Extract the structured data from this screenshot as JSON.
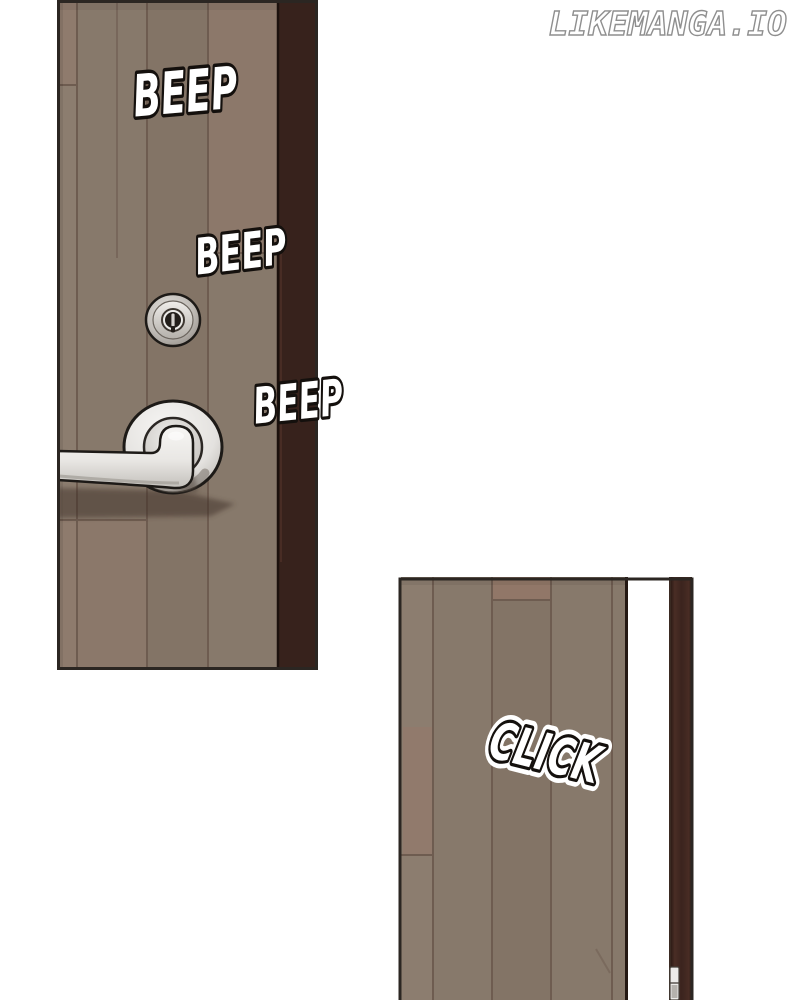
{
  "watermark": {
    "text": "LIKEMANGA.IO"
  },
  "sfx": {
    "beep_top": "BEEP",
    "beep_middle": "BEEP",
    "beep_bottom": "BEEP",
    "click": "CLICK"
  },
  "colors": {
    "background": "#ffffff",
    "panel-border": "#2b2622",
    "door-face": "#87796b",
    "door-face-light": "#8c7d6f",
    "door-face-dark": "#837466",
    "door-red-tint": "#96786a",
    "door-plank-line": "#6e5c50",
    "door-edge-strip": "#37221c",
    "door-edge-line": "#241813",
    "frame-strip": "#3b241e",
    "metal-light": "#f2f1ef",
    "metal-mid": "#d6d3cf",
    "metal-dark": "#a49f99",
    "outline-dark": "#1d1a17",
    "sfx-fill": "#ffffff",
    "sfx-outline": "#14100d",
    "sfx-halo": "#ffffff",
    "watermark-fill": "#ffffff",
    "watermark-outline": "#8f8f8f"
  }
}
